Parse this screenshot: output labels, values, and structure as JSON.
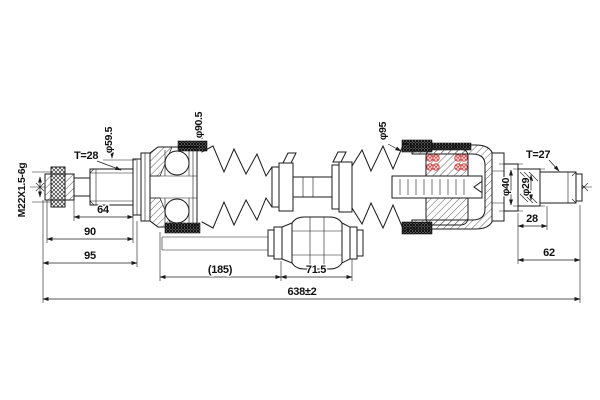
{
  "colors": {
    "background": "#ffffff",
    "line": "#1b1b1b",
    "highlight_red": "#cc2a2a"
  },
  "labels": {
    "thread_spec": "M22X1.5-6g",
    "spline_left": "T=28",
    "dia_59_5": "φ59.5",
    "dia_90_5": "φ90.5",
    "dia_95": "φ95",
    "dia_40": "φ40",
    "dia_29": "φ29",
    "spline_right": "T=27"
  },
  "dimensions": {
    "spline_section": "64",
    "stub_90": "90",
    "stub_95": "95",
    "shaft_ref": "(185)",
    "damper_length": "71.5",
    "overall_length": "638±2",
    "right_spline": "28",
    "right_stub": "62"
  }
}
